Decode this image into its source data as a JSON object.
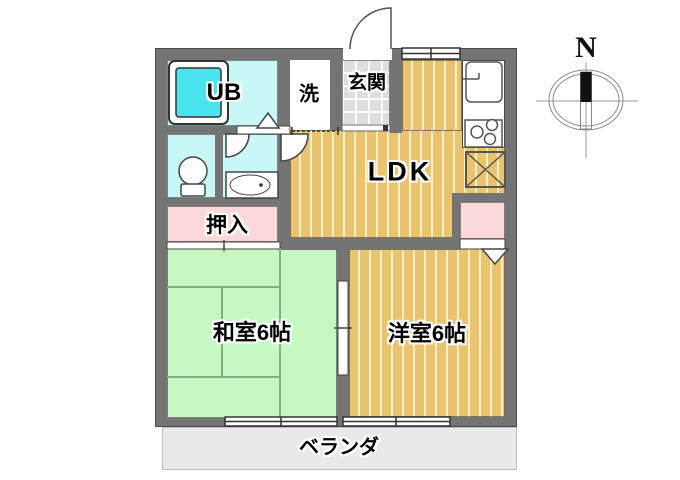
{
  "labels": {
    "ub": "UB",
    "laundry": "洗",
    "entrance": "玄関",
    "ldk": "LDK",
    "oshiire": "押入",
    "washitsu": "和室6帖",
    "youshitsu": "洋室6帖",
    "veranda": "ベランダ",
    "compass_n": "N"
  },
  "colors": {
    "wall": "#747474",
    "water_room": "#c9f6f6",
    "bathtub": "#4ae4ef",
    "wood_floor": "#e9c36e",
    "tatami_green": "#c6f8c3",
    "closet_pink": "#fbd8da",
    "entrance_tile": "#dedede",
    "veranda_gray": "#e9e9e9"
  }
}
